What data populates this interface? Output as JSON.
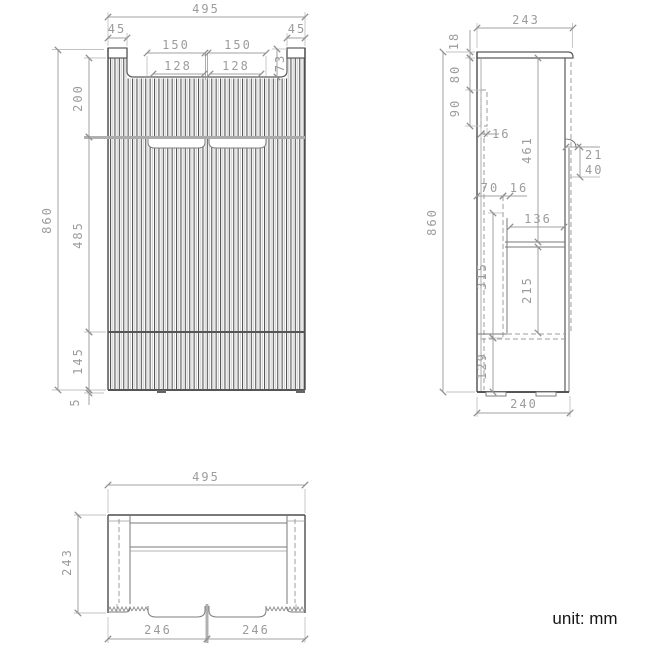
{
  "unit_note": "unit: mm",
  "front_view": {
    "dims": {
      "overall_width": "495",
      "post_left": "45",
      "post_right": "45",
      "door_left": "150",
      "door_right": "150",
      "recess_left": "128",
      "recess_right": "128",
      "top_recess_depth": "73",
      "top_section": "200",
      "overall_height": "860",
      "middle_section": "485",
      "bottom_section": "145",
      "base_gap": "5"
    }
  },
  "side_view": {
    "dims": {
      "overall_depth": "243",
      "top_thickness": "18",
      "cleat_offset": "80",
      "cleat_height": "90",
      "cleat_depth": "16",
      "door_height": "461",
      "handle_lip": "21",
      "handle_zone": "40",
      "back_offset": "70",
      "slide_gap": "16",
      "drawer_depth": "136",
      "overall_height": "860",
      "drawer_zone": "315",
      "drawer_box": "215",
      "bottom_zone": "129",
      "base_depth": "240"
    }
  },
  "top_view": {
    "dims": {
      "overall_width": "495",
      "overall_depth": "243",
      "door_left": "246",
      "door_right": "246"
    }
  }
}
